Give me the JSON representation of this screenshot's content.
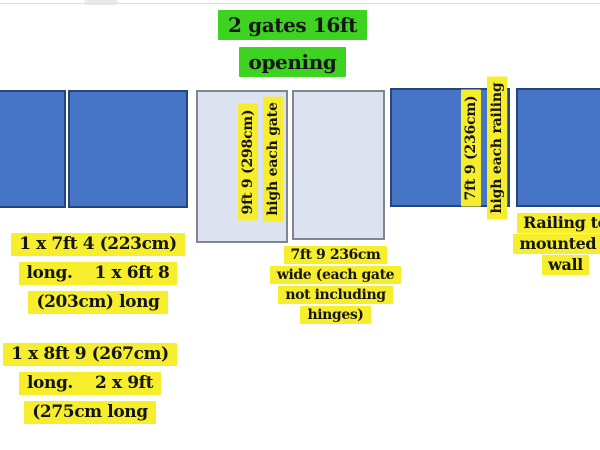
{
  "title": {
    "line1": "2 gates 16ft",
    "line2": "opening"
  },
  "gates": {
    "height_line1": "9ft 9 (298cm)",
    "height_line2": "high each gate"
  },
  "railings": {
    "height_line1": "7ft 9 (236cm)",
    "height_line2": "high each railing"
  },
  "notes": {
    "left_top": [
      "1 x 7ft 4 (223cm)",
      "long.    1 x 6ft 8",
      "(203cm) long"
    ],
    "left_bottom": [
      "1 x 8ft 9 (267cm)",
      "long.    2 x 9ft",
      "(275cm long"
    ],
    "center": [
      "7ft 9 236cm",
      "wide (each gate",
      "not including",
      "hinges)"
    ],
    "right": [
      "Railing to",
      "mounted o",
      "wall"
    ]
  },
  "colors": {
    "highlight_green": "#3fd321",
    "highlight_yellow": "#f6ee2d",
    "panel_blue": "#4575c4",
    "panel_border": "#24457e",
    "gate_fill": "#dde2f1",
    "gate_border": "#80868f"
  }
}
